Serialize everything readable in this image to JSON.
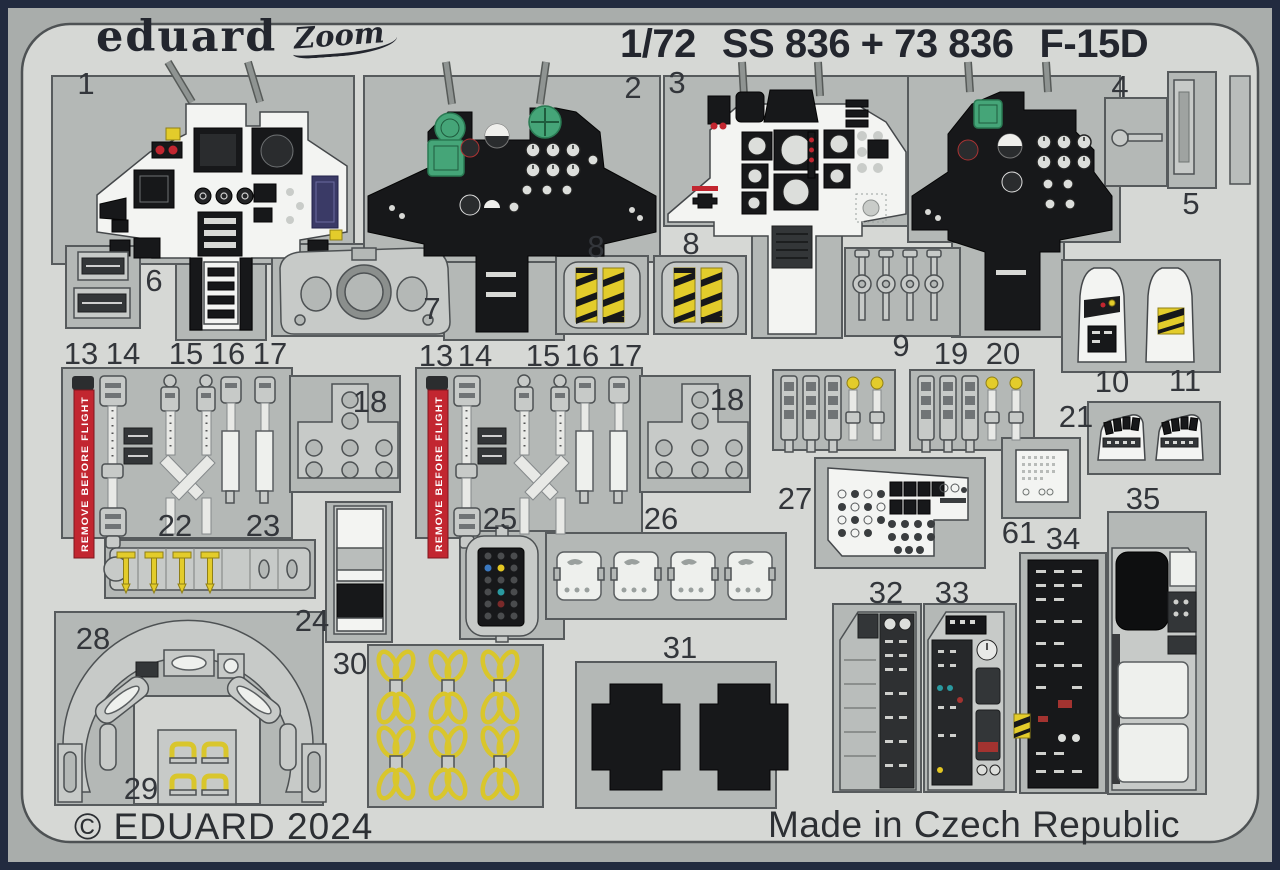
{
  "header": {
    "brand": "eduard",
    "brand_script": "Zoom",
    "scale": "1/72",
    "product_code": "SS 836 + 73 836",
    "aircraft": "F-15D"
  },
  "footer": {
    "copyright": "© EDUARD 2024",
    "origin": "Made in Czech Republic"
  },
  "streamer_text": "REMOVE BEFORE FLIGHT",
  "part_labels": [
    "1",
    "2",
    "3",
    "4",
    "5",
    "6",
    "7",
    "8",
    "8",
    "9",
    "10",
    "11",
    "13",
    "14",
    "15",
    "16",
    "17",
    "18",
    "13",
    "14",
    "15",
    "16",
    "17",
    "18",
    "19",
    "20",
    "21",
    "22",
    "23",
    "24",
    "25",
    "26",
    "27",
    "28",
    "29",
    "30",
    "31",
    "32",
    "33",
    "34",
    "35",
    "61"
  ],
  "colors": {
    "border": "#222b3f",
    "fret": "#d6d8d5",
    "backing": "#a9adab",
    "opening": "#b4b8b6",
    "part_white": "#f3f4f2",
    "part_black": "#17181a",
    "accent_red": "#c22630",
    "accent_yellow": "#e3cc2b",
    "accent_green": "#45a578",
    "label_text": "#33363b"
  }
}
